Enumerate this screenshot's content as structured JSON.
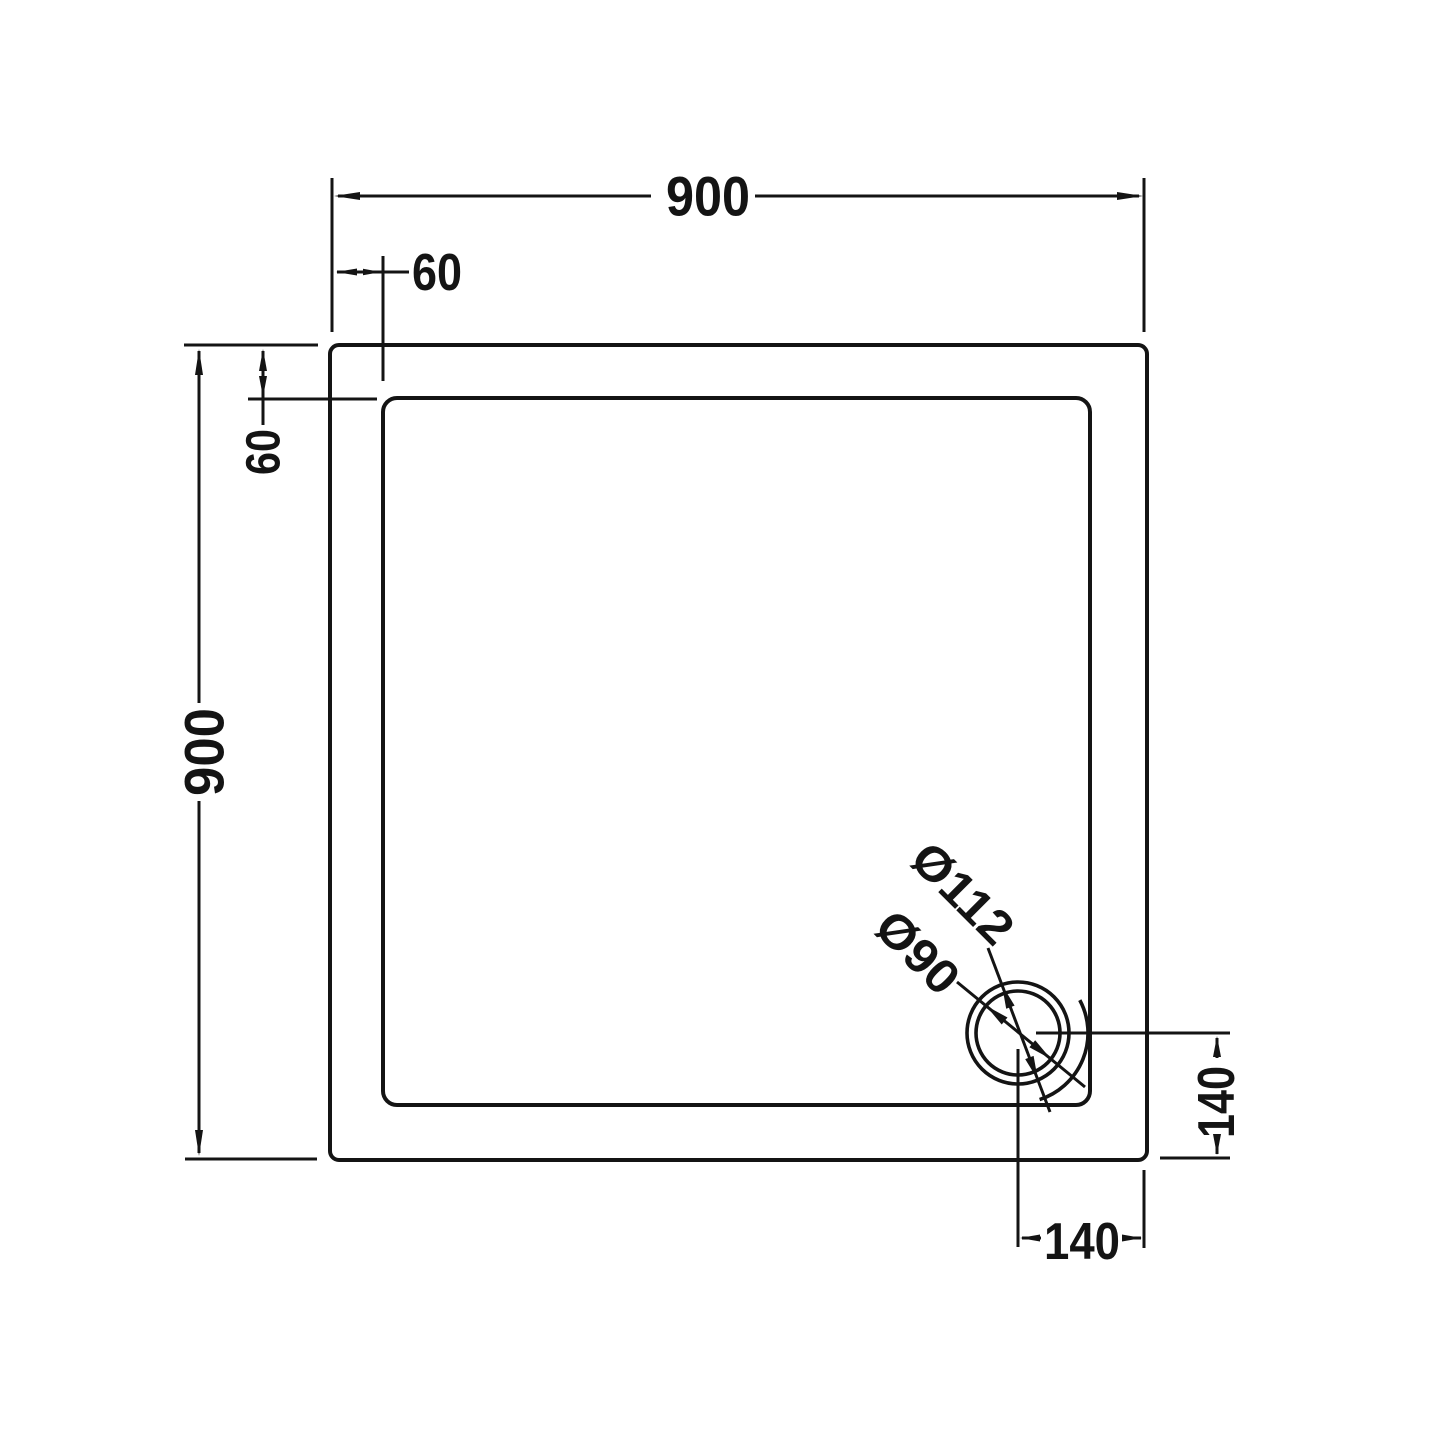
{
  "drawing": {
    "labels": {
      "width_total": "900",
      "height_total": "900",
      "inset_top": "60",
      "inset_left": "60",
      "drain_offset_bottom": "140",
      "drain_offset_right": "140",
      "drain_flange_diameter": "Ø112",
      "drain_hole_diameter": "Ø90"
    },
    "colors": {
      "line": "#141414",
      "background": "#ffffff"
    }
  }
}
